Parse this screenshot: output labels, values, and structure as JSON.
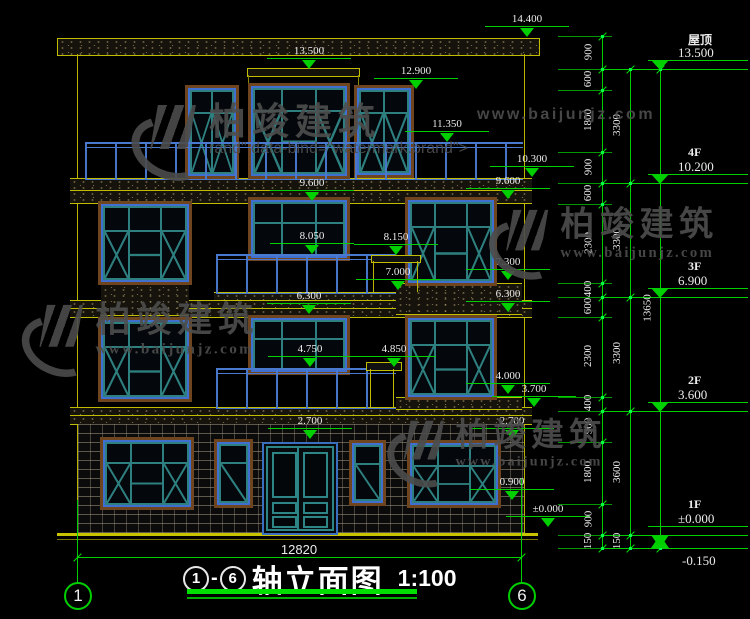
{
  "watermark": {
    "brand": "柏竣建筑",
    "url": "www.baijunjz.com"
  },
  "title": {
    "axis_left": "1",
    "axis_right": "6",
    "name": "轴立面图",
    "scale": "1:100"
  },
  "axes": {
    "left": "1",
    "right": "6"
  },
  "ground_dim": "12820",
  "markers": [
    {
      "v": "14.400",
      "x": 527,
      "y": 38
    },
    {
      "v": "13.500",
      "x": 309,
      "y": 70
    },
    {
      "v": "12.900",
      "x": 416,
      "y": 90
    },
    {
      "v": "11.350",
      "x": 447,
      "y": 143
    },
    {
      "v": "10.300",
      "x": 532,
      "y": 178
    },
    {
      "v": "9.600",
      "x": 312,
      "y": 202
    },
    {
      "v": "9.600",
      "x": 508,
      "y": 200
    },
    {
      "v": "8.150",
      "x": 396,
      "y": 256
    },
    {
      "v": "8.050",
      "x": 312,
      "y": 255
    },
    {
      "v": "7.300",
      "x": 508,
      "y": 281
    },
    {
      "v": "7.000",
      "x": 398,
      "y": 291
    },
    {
      "v": "6.300",
      "x": 309,
      "y": 315
    },
    {
      "v": "6.300",
      "x": 508,
      "y": 313
    },
    {
      "v": "4.850",
      "x": 394,
      "y": 368
    },
    {
      "v": "4.750",
      "x": 310,
      "y": 368
    },
    {
      "v": "4.000",
      "x": 508,
      "y": 395
    },
    {
      "v": "3.700",
      "x": 534,
      "y": 408
    },
    {
      "v": "2.700",
      "x": 310,
      "y": 440
    },
    {
      "v": "2.700",
      "x": 512,
      "y": 440
    },
    {
      "v": "0.900",
      "x": 512,
      "y": 501
    },
    {
      "v": "±0.000",
      "x": 548,
      "y": 528
    }
  ],
  "levels": [
    {
      "label": "屋顶",
      "v": "13.500",
      "y": 69
    },
    {
      "label": "4F",
      "v": "10.200",
      "y": 183
    },
    {
      "label": "3F",
      "v": "6.900",
      "y": 297
    },
    {
      "label": "2F",
      "v": "3.600",
      "y": 411
    },
    {
      "label": "1F",
      "v": "±0.000",
      "y": 535
    },
    {
      "label": "",
      "v": "-0.150",
      "y": 548
    }
  ],
  "chains": [
    {
      "x": 602,
      "tx": 588,
      "stub": true,
      "segs": [
        [
          "900",
          36,
          69
        ],
        [
          "600",
          69,
          90
        ],
        [
          "1800",
          90,
          152
        ],
        [
          "900",
          152,
          183
        ],
        [
          "600",
          183,
          204
        ],
        [
          "2300",
          204,
          283
        ],
        [
          "400",
          283,
          297
        ],
        [
          "600",
          297,
          317
        ],
        [
          "2300",
          317,
          397
        ],
        [
          "400",
          397,
          411
        ],
        [
          "900",
          411,
          442
        ],
        [
          "1800",
          442,
          504
        ],
        [
          "900",
          504,
          535
        ],
        [
          "150",
          535,
          548
        ]
      ]
    },
    {
      "x": 630,
      "tx": 617,
      "stub": false,
      "segs": [
        [
          "3300",
          69,
          183
        ],
        [
          "3300",
          183,
          297
        ],
        [
          "3300",
          297,
          411
        ],
        [
          "3600",
          411,
          535
        ],
        [
          "150",
          535,
          548
        ]
      ]
    },
    {
      "x": 660,
      "tx": 647,
      "stub": false,
      "segs": [
        [
          "13650",
          69,
          548
        ]
      ]
    }
  ]
}
